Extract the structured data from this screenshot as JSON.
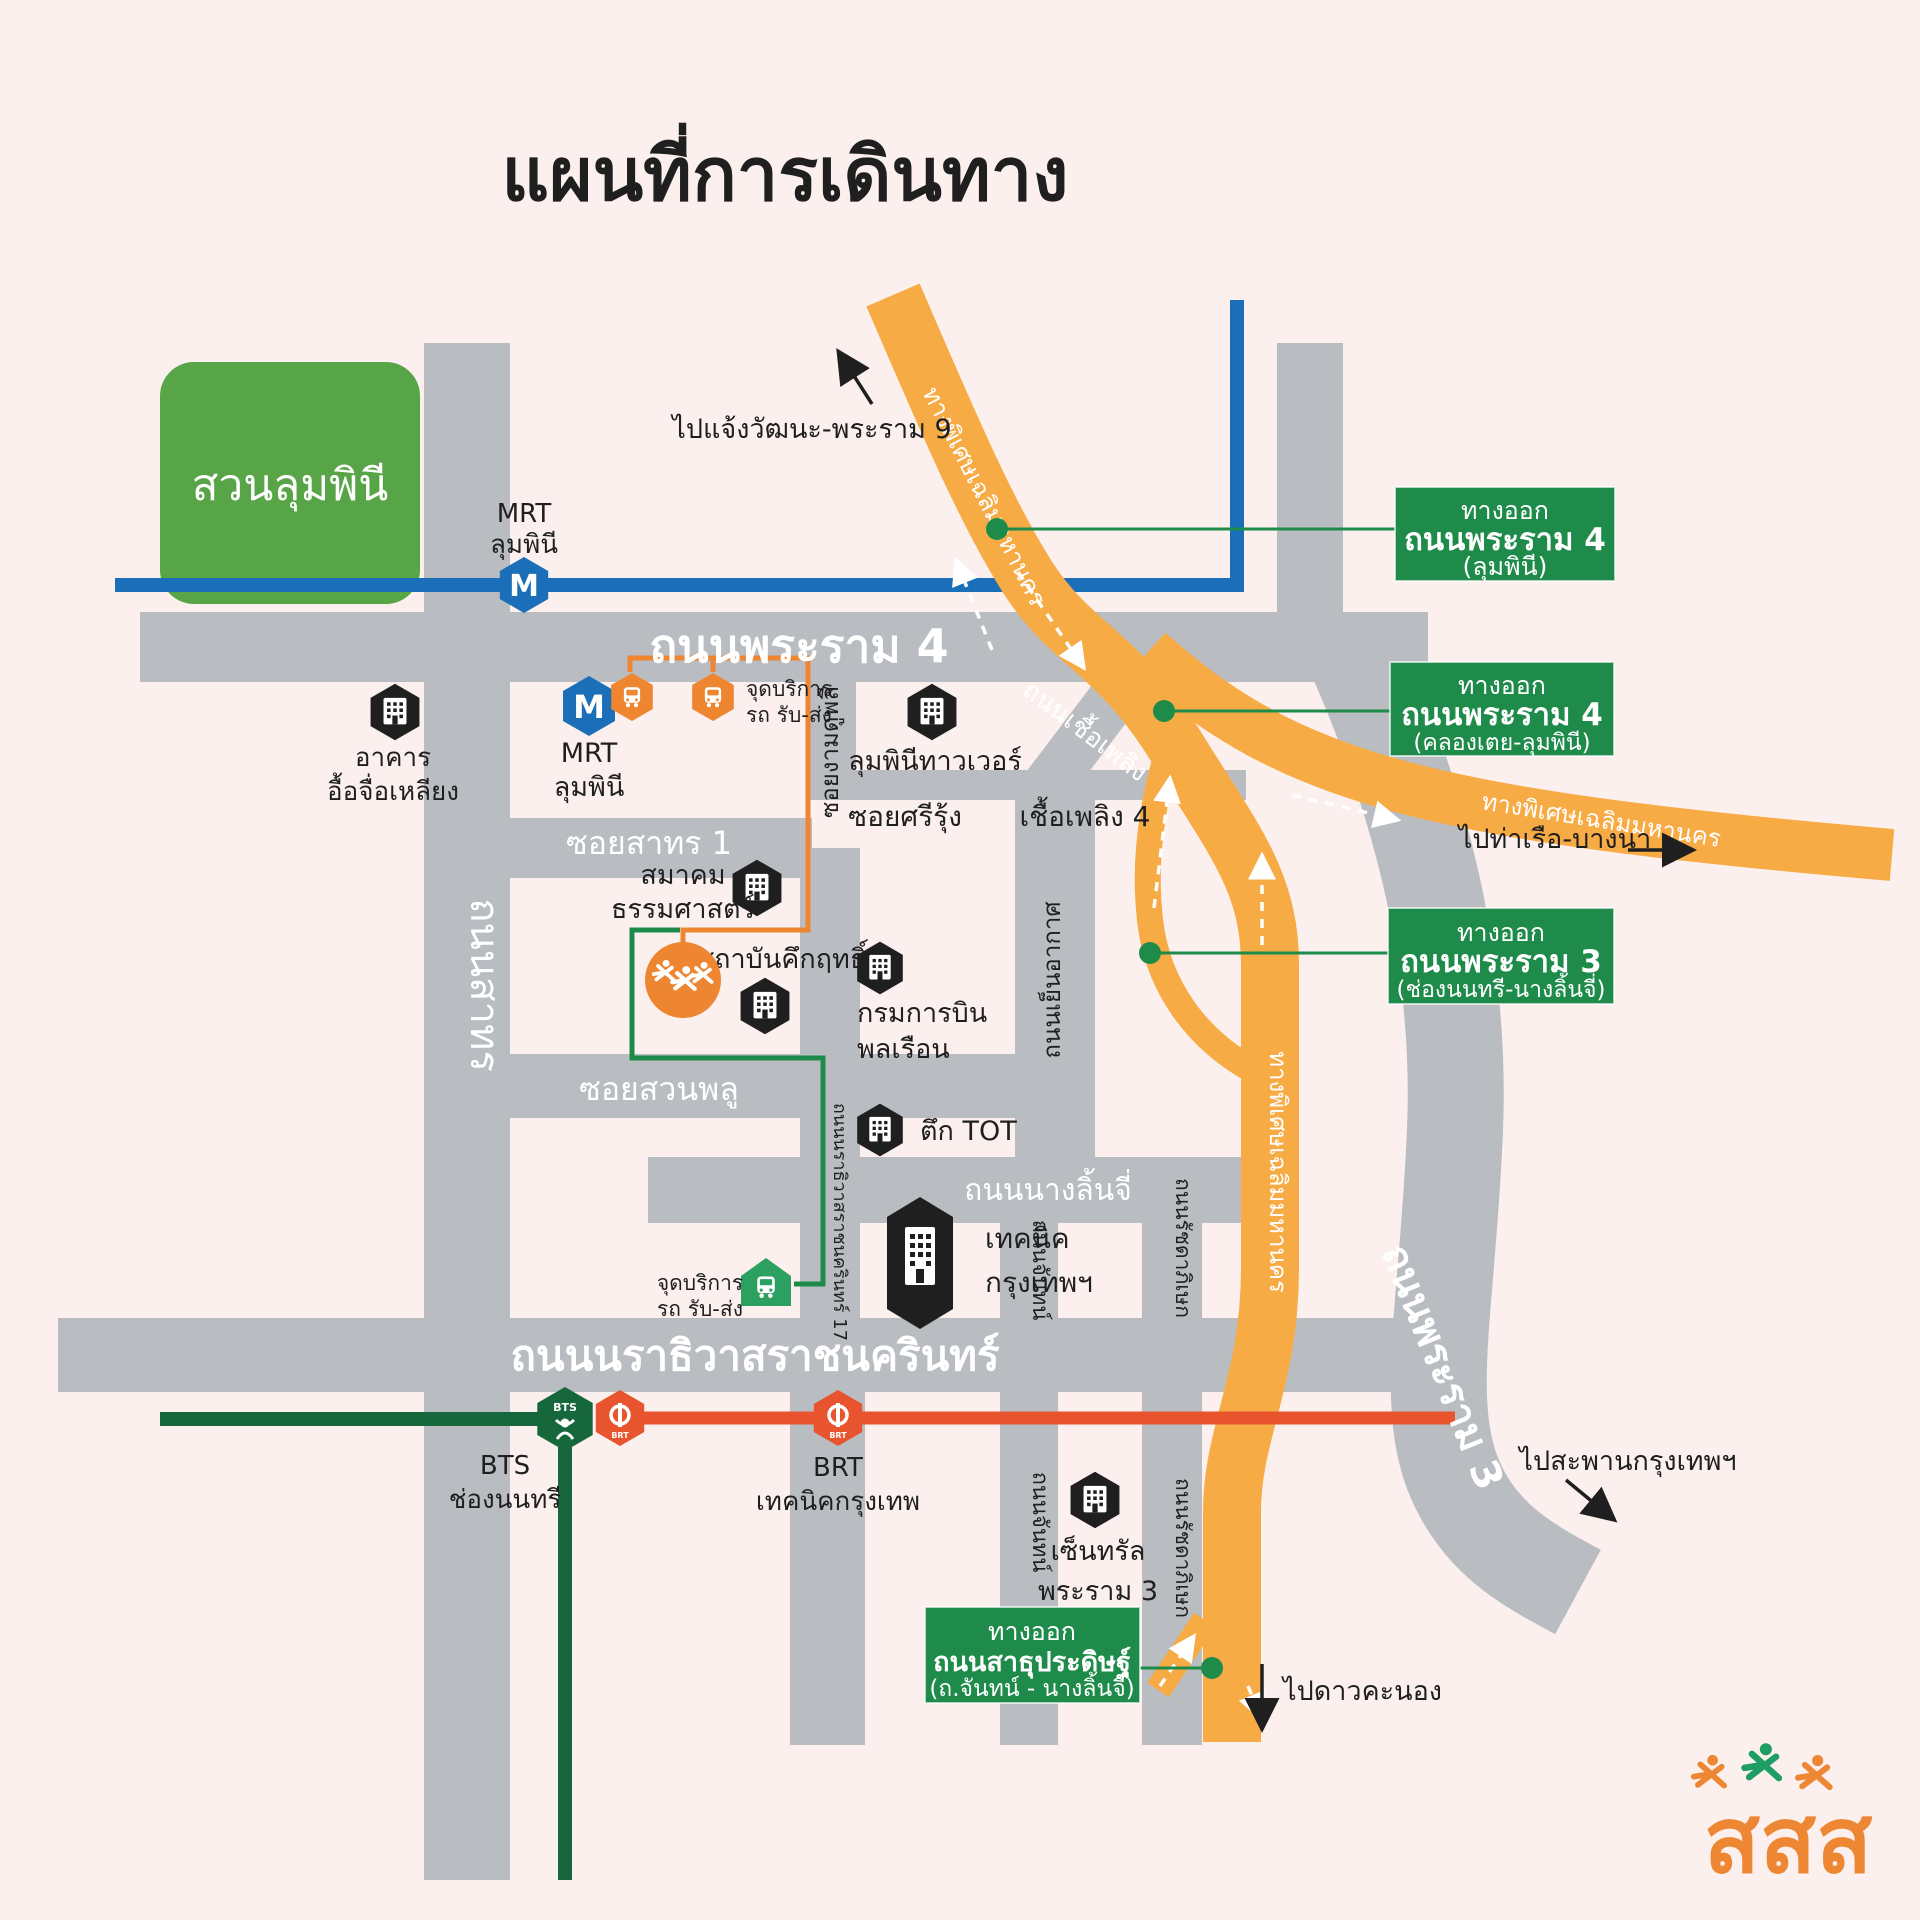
{
  "title": "แผนที่การเดินทาง",
  "park": {
    "name": "สวนลุมพินี"
  },
  "roads": {
    "rama4": "ถนนพระราม 4",
    "sathorn": "ถนนสาทร",
    "soi_sathorn1": "ซอยสาทร 1",
    "soi_suan_phlu": "ซอยสวนพลู",
    "soi_ngam_duphli": "ซอยงามดูพลี",
    "soi_sri_rung": "ซอยศรีรุ้ง",
    "chuea_phloeng_4": "เชื้อเพลิง 4",
    "chuea_phloeng_rd": "ถนนเชื้อเพลิง",
    "yen_akat": "ถนนเย็นอากาศ",
    "nang_linchi": "ถนนนางลิ้นจี่",
    "narathiwat": "ถนนนราธิวาสราชนครินทร์",
    "narathiwat_17": "ถนนนราธิวาสราชนครินทร์ 17",
    "chan_upper": "ถนนจันทน์",
    "chan_lower": "ถนนจันทน์",
    "ratchada_upper": "ถนนรัชดาภิเษก",
    "ratchada_lower": "ถนนรัชดาภิเษก",
    "rama3": "ถนนพระราม 3",
    "expressway_diagonal": "ทางพิเศษเฉลิมมหานคร",
    "expressway_branch": "ทางพิเศษเฉลิมมหานคร",
    "expressway_vertical": "ทางพิเศษเฉลิมมหานคร"
  },
  "directions": {
    "chaengwattana": "ไปแจ้งวัฒนะ-พระราม 9",
    "port_bangna": "ไปท่าเรือ-บางนา",
    "bangkok_bridge": "ไปสะพานกรุงเทพฯ",
    "dao_khanong": "ไปดาวคะนอง"
  },
  "exits": {
    "exit1": {
      "line1": "ทางออก",
      "line2": "ถนนพระราม 4",
      "line3": "(ลุมพินี)"
    },
    "exit2": {
      "line1": "ทางออก",
      "line2": "ถนนพระราม 4",
      "line3": "(คลองเตย-ลุมพินี)"
    },
    "exit3": {
      "line1": "ทางออก",
      "line2": "ถนนพระราม 3",
      "line3": "(ช่องนนทรี-นางลิ้นจี่)"
    },
    "exit4": {
      "line1": "ทางออก",
      "line2": "ถนนสาธุประดิษฐ์",
      "line3": "(ถ.จันทน์ - นางลิ้นจี่)"
    }
  },
  "stations": {
    "mrt_top": {
      "line1": "MRT",
      "line2": "ลุมพินี"
    },
    "mrt_lower": {
      "line1": "MRT",
      "line2": "ลุมพินี"
    },
    "bts": {
      "line1": "BTS",
      "line2": "ช่องนนทรี"
    },
    "brt": {
      "line1": "BRT",
      "line2": "เทคนิคกรุงเทพ"
    },
    "shuttle_top": {
      "line1": "จุดบริการ",
      "line2": "รถ รับ-ส่ง"
    },
    "shuttle_bottom": {
      "line1": "จุดบริการ",
      "line2": "รถ รับ-ส่ง"
    }
  },
  "buildings": {
    "ue_chu_liang": {
      "line1": "อาคาร",
      "line2": "อื้อจื่อเหลียง"
    },
    "chanpen": {
      "line1": "ภัตตาคาร",
      "line2": "จันทร์เพ็ญ"
    },
    "lumpini_tower": {
      "line1": "ลุมพินีทาวเวอร์"
    },
    "thammasat": {
      "line1": "สมาคม",
      "line2": "ธรรมศาสตร์"
    },
    "kukrit": {
      "line1": "สถาบันคึกฤทธิ์"
    },
    "aviation": {
      "line1": "กรมการบิน",
      "line2": "พลเรือน"
    },
    "tot": {
      "line1": "ตึก TOT"
    },
    "technic": {
      "line1": "เทคนิค",
      "line2": "กรุงเทพฯ"
    },
    "central": {
      "line1": "เซ็นทรัล",
      "line2": "พระราม 3"
    }
  },
  "icons": {
    "mrt_letter": "M",
    "bts_text": "BTS",
    "brt_text": "BRT"
  },
  "logo": {
    "text": "สสส"
  },
  "colors": {
    "background": "#fbf0ee",
    "road_gray": "#b9bdc2",
    "park_green": "#57a546",
    "exit_sign_green": "#1e8b4b",
    "mrt_blue": "#1b6fb8",
    "expressway_orange": "#f7ab45",
    "route_orange": "#ee8531",
    "brt_orange": "#e8542d",
    "bts_green": "#17673c",
    "shuttle_green": "#2ba061",
    "logo_orange": "#ee8733",
    "text_black": "#1f1f1f"
  }
}
